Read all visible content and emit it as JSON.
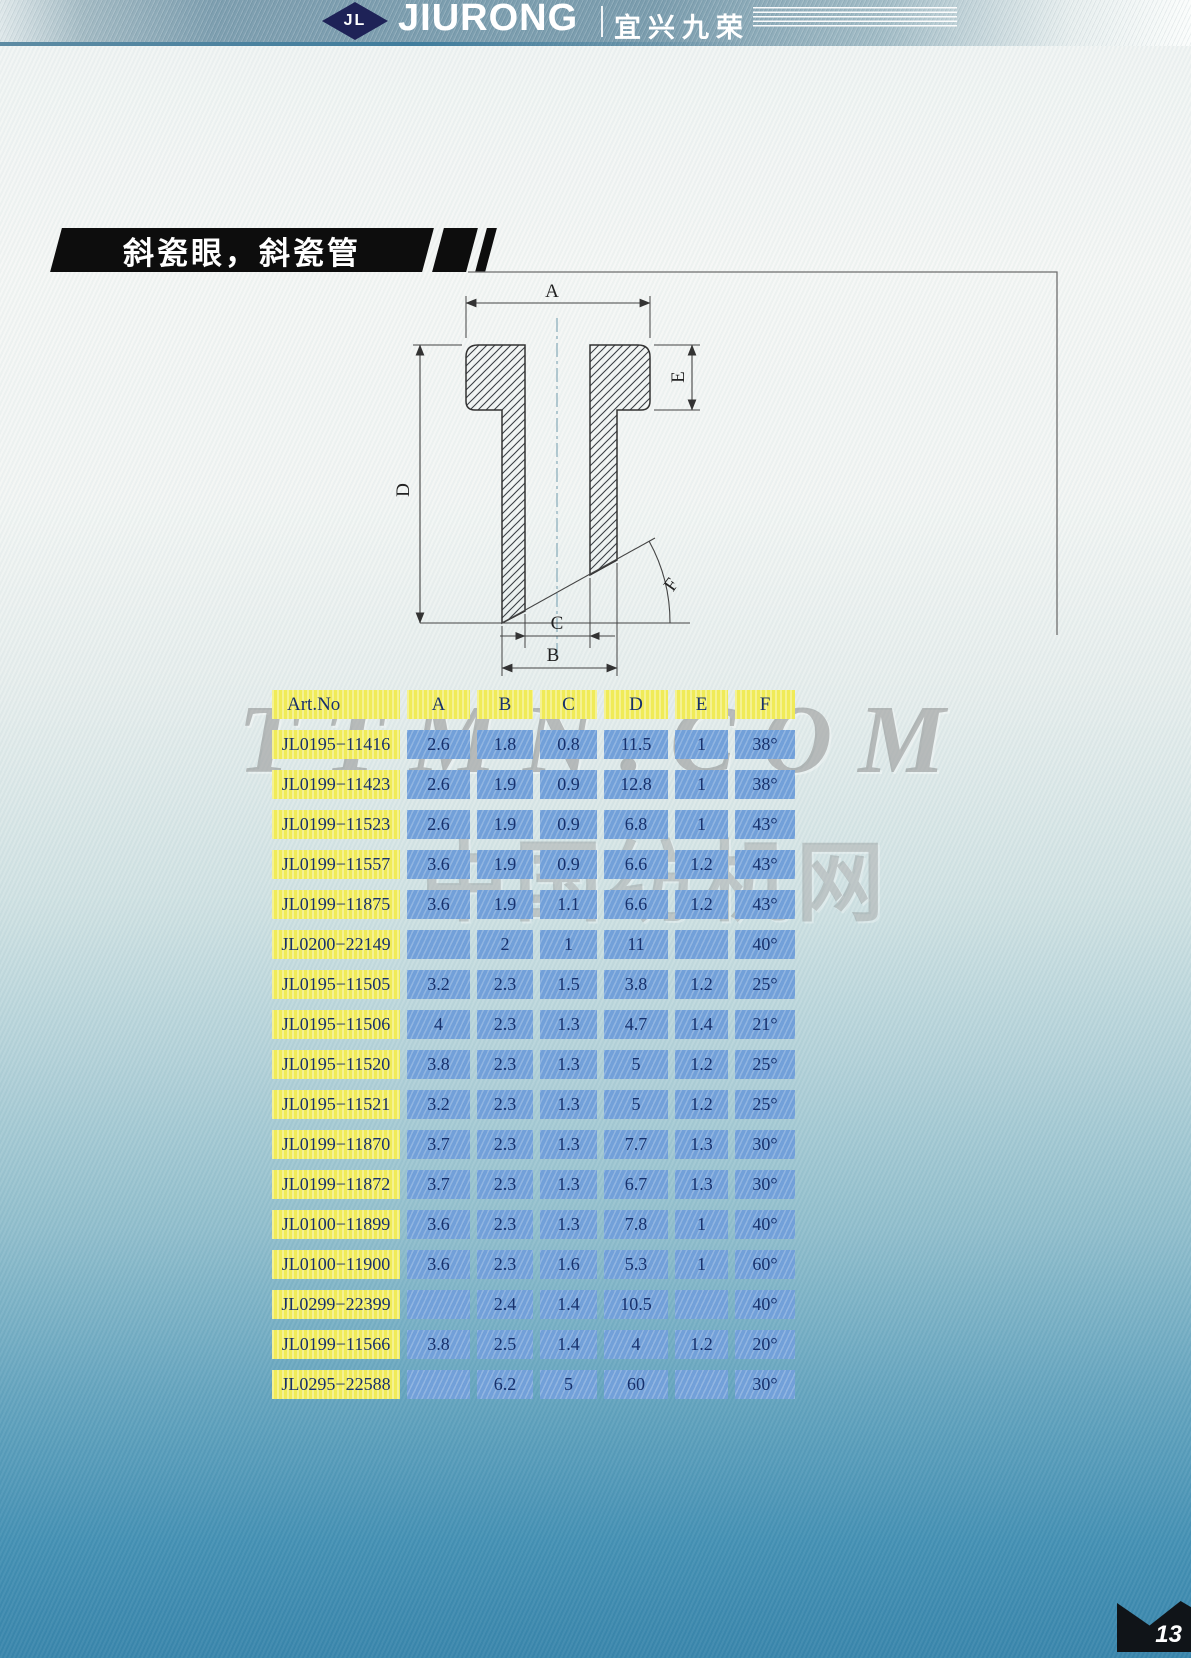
{
  "brand": {
    "logo_text": "JL",
    "name_en": "JIURONG",
    "name_cn": "宜兴九荣"
  },
  "section": {
    "title": "斜瓷眼，斜瓷管"
  },
  "watermarks": {
    "line1": "TTMN.COM",
    "line2": "中国纺机网"
  },
  "page_number": "13",
  "diagram": {
    "labels": {
      "a": "A",
      "b": "B",
      "c": "C",
      "d": "D",
      "e": "E",
      "f": "F"
    }
  },
  "chart_data": {
    "type": "table",
    "columns": [
      "Art.No",
      "A",
      "B",
      "C",
      "D",
      "E",
      "F"
    ],
    "rows": [
      [
        "JL0195−11416",
        "2.6",
        "1.8",
        "0.8",
        "11.5",
        "1",
        "38°"
      ],
      [
        "JL0199−11423",
        "2.6",
        "1.9",
        "0.9",
        "12.8",
        "1",
        "38°"
      ],
      [
        "JL0199−11523",
        "2.6",
        "1.9",
        "0.9",
        "6.8",
        "1",
        "43°"
      ],
      [
        "JL0199−11557",
        "3.6",
        "1.9",
        "0.9",
        "6.6",
        "1.2",
        "43°"
      ],
      [
        "JL0199−11875",
        "3.6",
        "1.9",
        "1.1",
        "6.6",
        "1.2",
        "43°"
      ],
      [
        "JL0200−22149",
        "",
        "2",
        "1",
        "11",
        "",
        "40°"
      ],
      [
        "JL0195−11505",
        "3.2",
        "2.3",
        "1.5",
        "3.8",
        "1.2",
        "25°"
      ],
      [
        "JL0195−11506",
        "4",
        "2.3",
        "1.3",
        "4.7",
        "1.4",
        "21°"
      ],
      [
        "JL0195−11520",
        "3.8",
        "2.3",
        "1.3",
        "5",
        "1.2",
        "25°"
      ],
      [
        "JL0195−11521",
        "3.2",
        "2.3",
        "1.3",
        "5",
        "1.2",
        "25°"
      ],
      [
        "JL0199−11870",
        "3.7",
        "2.3",
        "1.3",
        "7.7",
        "1.3",
        "30°"
      ],
      [
        "JL0199−11872",
        "3.7",
        "2.3",
        "1.3",
        "6.7",
        "1.3",
        "30°"
      ],
      [
        "JL0100−11899",
        "3.6",
        "2.3",
        "1.3",
        "7.8",
        "1",
        "40°"
      ],
      [
        "JL0100−11900",
        "3.6",
        "2.3",
        "1.6",
        "5.3",
        "1",
        "60°"
      ],
      [
        "JL0299−22399",
        "",
        "2.4",
        "1.4",
        "10.5",
        "",
        "40°"
      ],
      [
        "JL0199−11566",
        "3.8",
        "2.5",
        "1.4",
        "4",
        "1.2",
        "20°"
      ],
      [
        "JL0295−22588",
        "",
        "6.2",
        "5",
        "60",
        "",
        "30°"
      ]
    ]
  },
  "colors": {
    "band_blue": "#7b9dae",
    "banner_bg": "#0d0d0d",
    "table_header_bg": "#f0eb58",
    "table_cell_bg": "#72a0d9",
    "table_text": "#17306b",
    "page_bottom": "#3a86ac",
    "logo_diamond": "#1e2257"
  }
}
